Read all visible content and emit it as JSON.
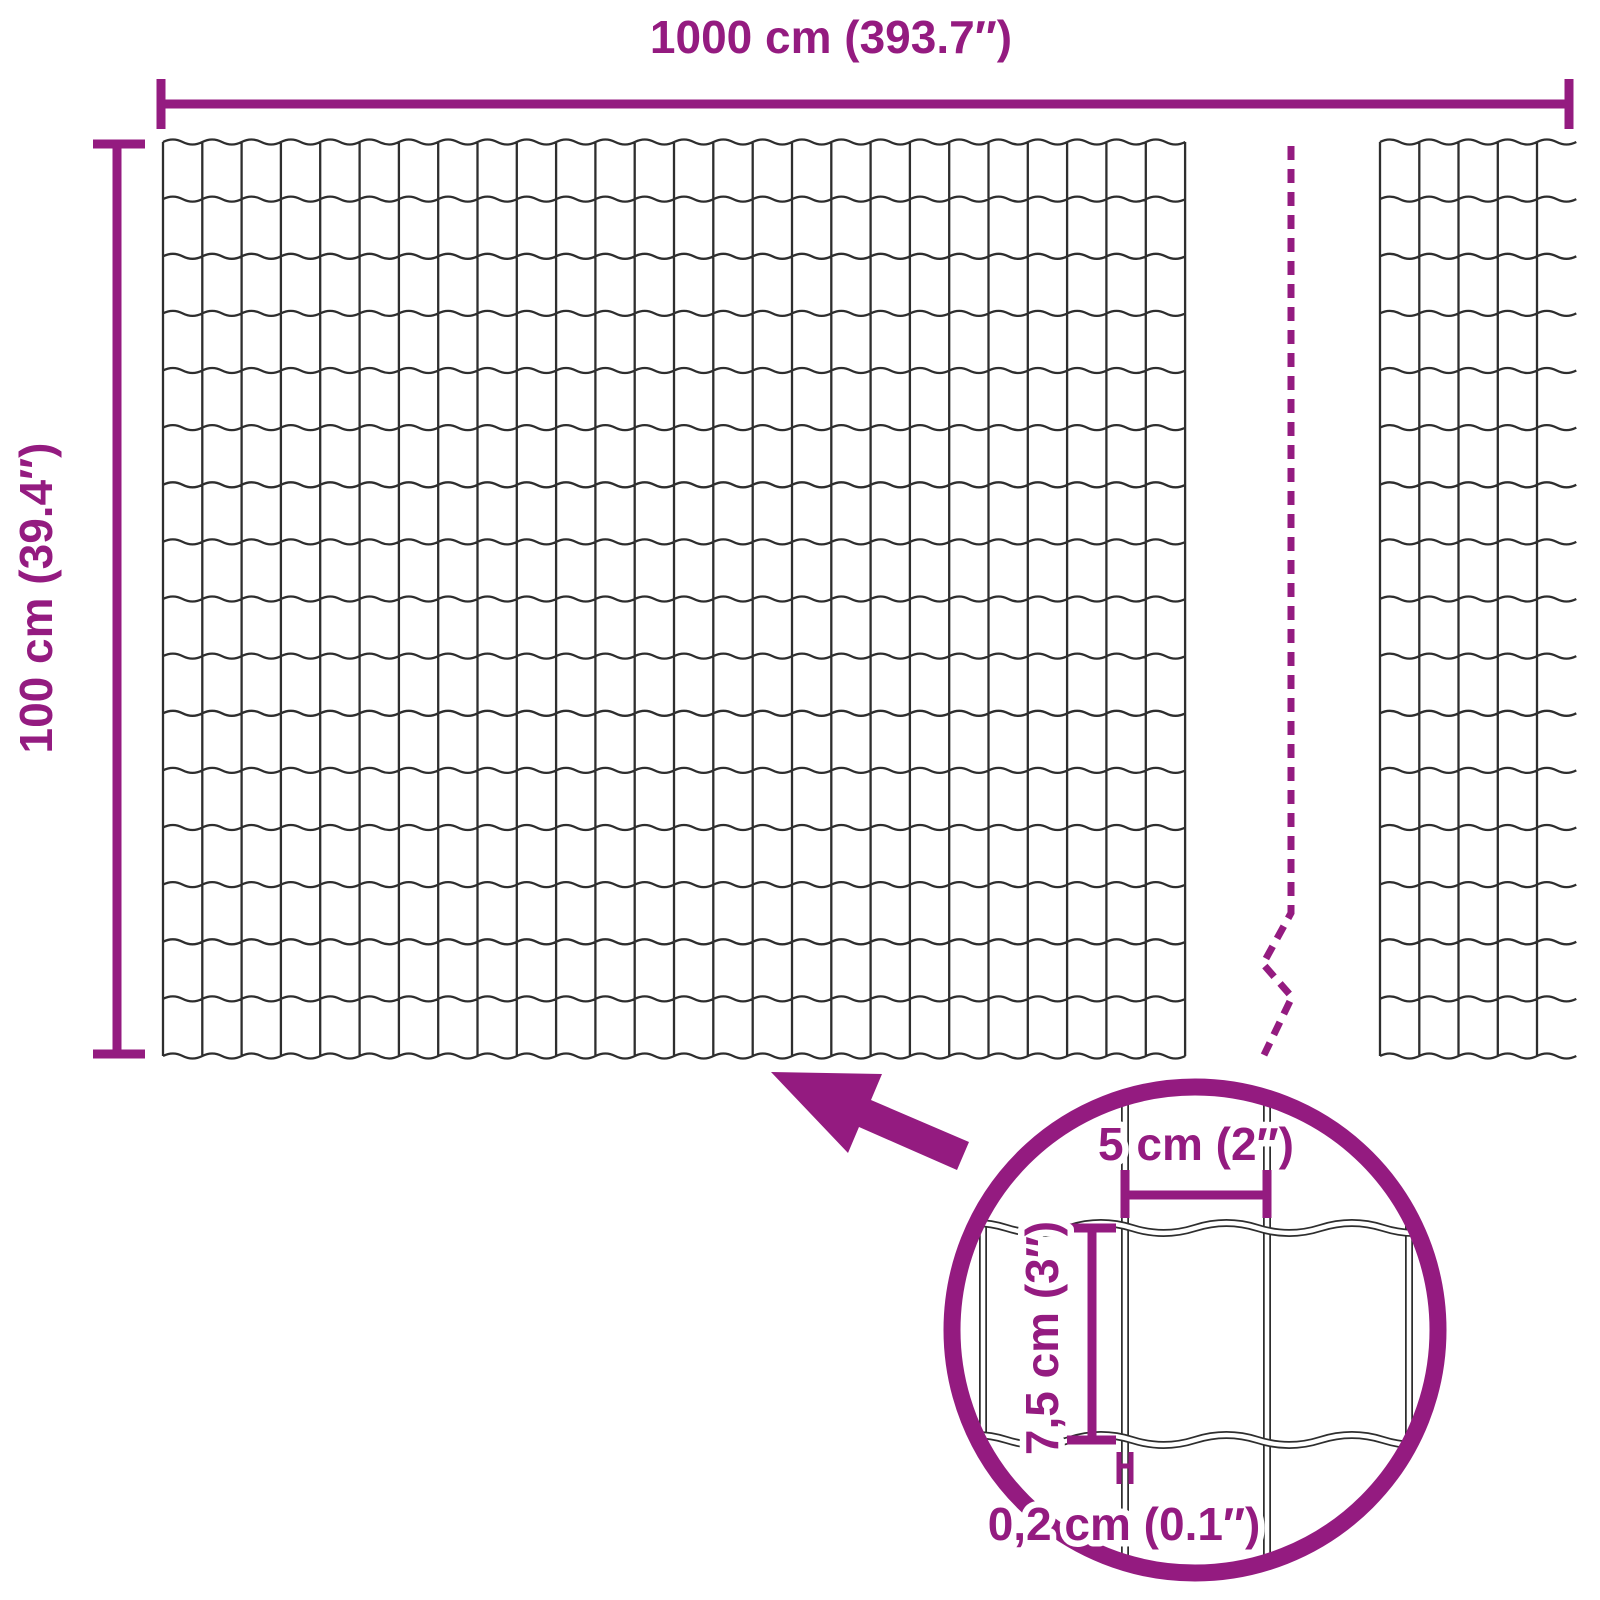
{
  "colors": {
    "accent": "#941B80",
    "wire": "#2E2E2E",
    "background": "#FFFFFF"
  },
  "dimensions": {
    "width_label": "1000 cm (393.7″)",
    "height_label": "100 cm (39.4″)"
  },
  "inset": {
    "cell_width_label": "5 cm (2″)",
    "cell_height_label": "7,5 cm (3″)",
    "wire_thickness_label": "0,2 cm (0.1″)"
  },
  "mesh": {
    "rows": 16,
    "main_columns": 26,
    "right_columns": 5
  }
}
